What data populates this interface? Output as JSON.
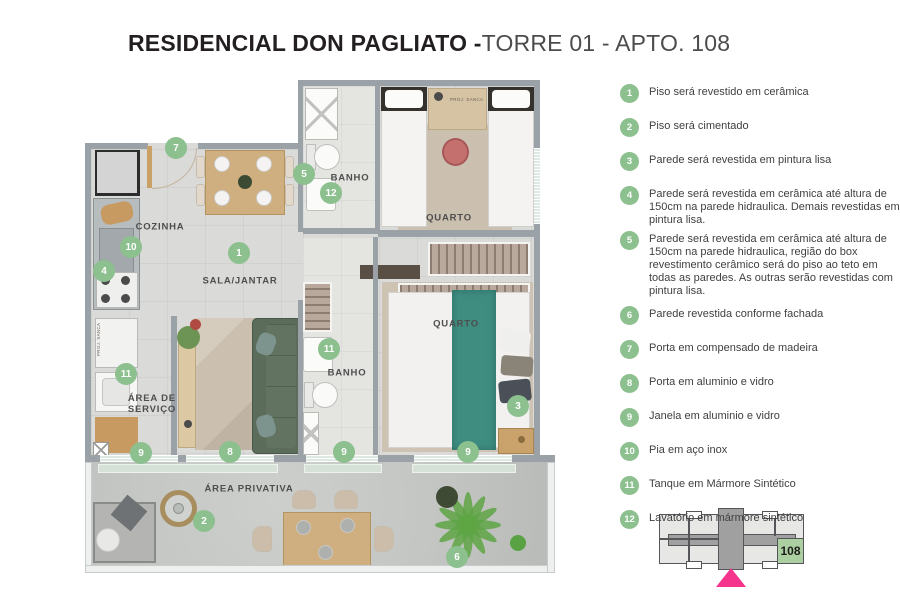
{
  "title": {
    "bold": "RESIDENCIAL DON PAGLIATO -",
    "light": "TORRE 01 - APTO. 108"
  },
  "legend": {
    "items": [
      {
        "num": "1",
        "text": "Piso será revestido em cerâmica"
      },
      {
        "num": "2",
        "text": "Piso será cimentado"
      },
      {
        "num": "3",
        "text": "Parede será revestida em pintura lisa"
      },
      {
        "num": "4",
        "text": "Parede será revestida em cerâmica até altura de 150cm na parede hidraulica. Demais revestidas em pintura lisa."
      },
      {
        "num": "5",
        "text": "Parede será revestida em cerâmica até altura de 150cm na parede hidraulica, região do box revestimento cerâmico será do piso ao teto em todas as paredes. As outras serão revestidas com pintura lisa."
      },
      {
        "num": "6",
        "text": "Parede revestida conforme fachada"
      },
      {
        "num": "7",
        "text": "Porta em compensado de madeira"
      },
      {
        "num": "8",
        "text": "Porta em aluminio e vidro"
      },
      {
        "num": "9",
        "text": "Janela em aluminio e vidro"
      },
      {
        "num": "10",
        "text": "Pia em aço inox"
      },
      {
        "num": "11",
        "text": "Tanque em Mármore Sintético"
      },
      {
        "num": "12",
        "text": "Lavatório em mármore sintético"
      }
    ]
  },
  "floorplan": {
    "proj_sanca": "PROJ. SANCA",
    "room_labels": [
      {
        "text": "COZINHA",
        "x": 160,
        "y": 227
      },
      {
        "text": "SALA/JANTAR",
        "x": 240,
        "y": 281
      },
      {
        "text": "BANHO",
        "x": 350,
        "y": 178
      },
      {
        "text": "QUARTO",
        "x": 449,
        "y": 218
      },
      {
        "text": "BANHO",
        "x": 347,
        "y": 373
      },
      {
        "text": "QUARTO",
        "x": 456,
        "y": 324
      },
      {
        "text": "ÁREA DE\nSERVIÇO",
        "x": 152,
        "y": 404
      },
      {
        "text": "ÁREA PRIVATIVA",
        "x": 249,
        "y": 489
      }
    ],
    "markers": [
      {
        "n": "7",
        "x": 176,
        "y": 148
      },
      {
        "n": "5",
        "x": 304,
        "y": 174
      },
      {
        "n": "12",
        "x": 331,
        "y": 193
      },
      {
        "n": "10",
        "x": 131,
        "y": 247
      },
      {
        "n": "1",
        "x": 239,
        "y": 253
      },
      {
        "n": "4",
        "x": 104,
        "y": 271
      },
      {
        "n": "11",
        "x": 126,
        "y": 374
      },
      {
        "n": "11",
        "x": 329,
        "y": 349
      },
      {
        "n": "3",
        "x": 518,
        "y": 406
      },
      {
        "n": "9",
        "x": 141,
        "y": 453
      },
      {
        "n": "8",
        "x": 230,
        "y": 452
      },
      {
        "n": "9",
        "x": 344,
        "y": 452
      },
      {
        "n": "9",
        "x": 468,
        "y": 452
      },
      {
        "n": "2",
        "x": 204,
        "y": 521
      },
      {
        "n": "6",
        "x": 457,
        "y": 557
      }
    ]
  },
  "keyplan": {
    "unit": "108"
  },
  "colors": {
    "marker_green": "#8cc08e",
    "keyplan_unit_green": "#abcfa0",
    "locator_pink": "#f5348e",
    "wall_grey": "#9aa1a7"
  }
}
